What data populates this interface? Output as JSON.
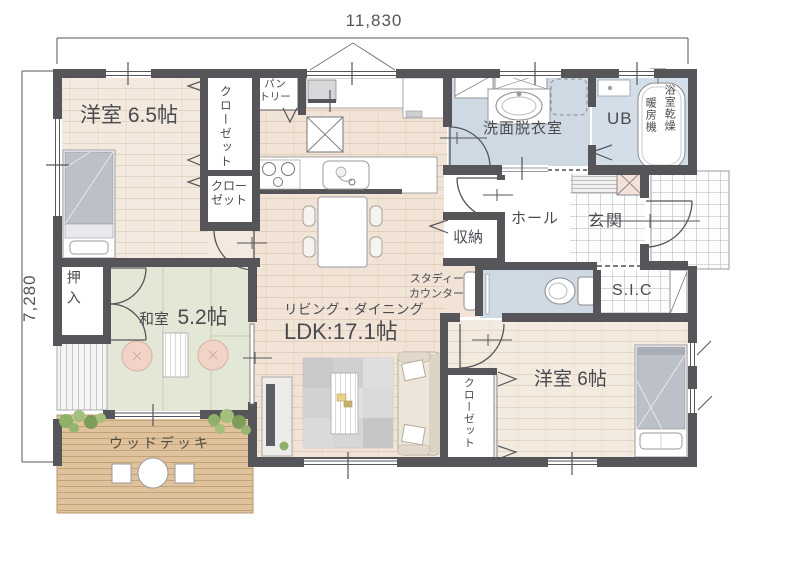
{
  "dimensions": {
    "top": "11,830",
    "left": "7,280"
  },
  "rooms": {
    "bedroom65": "洋室 6.5帖",
    "closet_tall": "クローゼット",
    "closet_small_line1": "クロー",
    "closet_small_line2": "ゼット",
    "pantry_line1": "パン",
    "pantry_line2": "トリー",
    "washroom": "洗面脱衣室",
    "unit_bath": "UB",
    "bath_dryer_col1": "浴室乾燥",
    "bath_dryer_col2": "暖房機",
    "hall": "ホール",
    "entrance": "玄関",
    "storage": "収納",
    "study_line1": "スタディー",
    "study_line2": "カウンター",
    "shoe_closet": "S.I.C",
    "oshiire": "押入",
    "japanese_room_name": "和室",
    "japanese_room_size": "5.2帖",
    "living_line1": "リビング・ダイニング",
    "living_line2": "LDK:17.1帖",
    "wood_deck": "ウッドデッキ",
    "bedroom6": "洋室 6帖",
    "closet_bedroom6": "クローゼット"
  },
  "colors": {
    "wall": "#55555a",
    "wood_floor": "#f2e6d9",
    "tatami": "#e3e7d5",
    "wet_room": "#ced9e3",
    "deck": "#dfc29b",
    "text": "#4a4a50"
  }
}
